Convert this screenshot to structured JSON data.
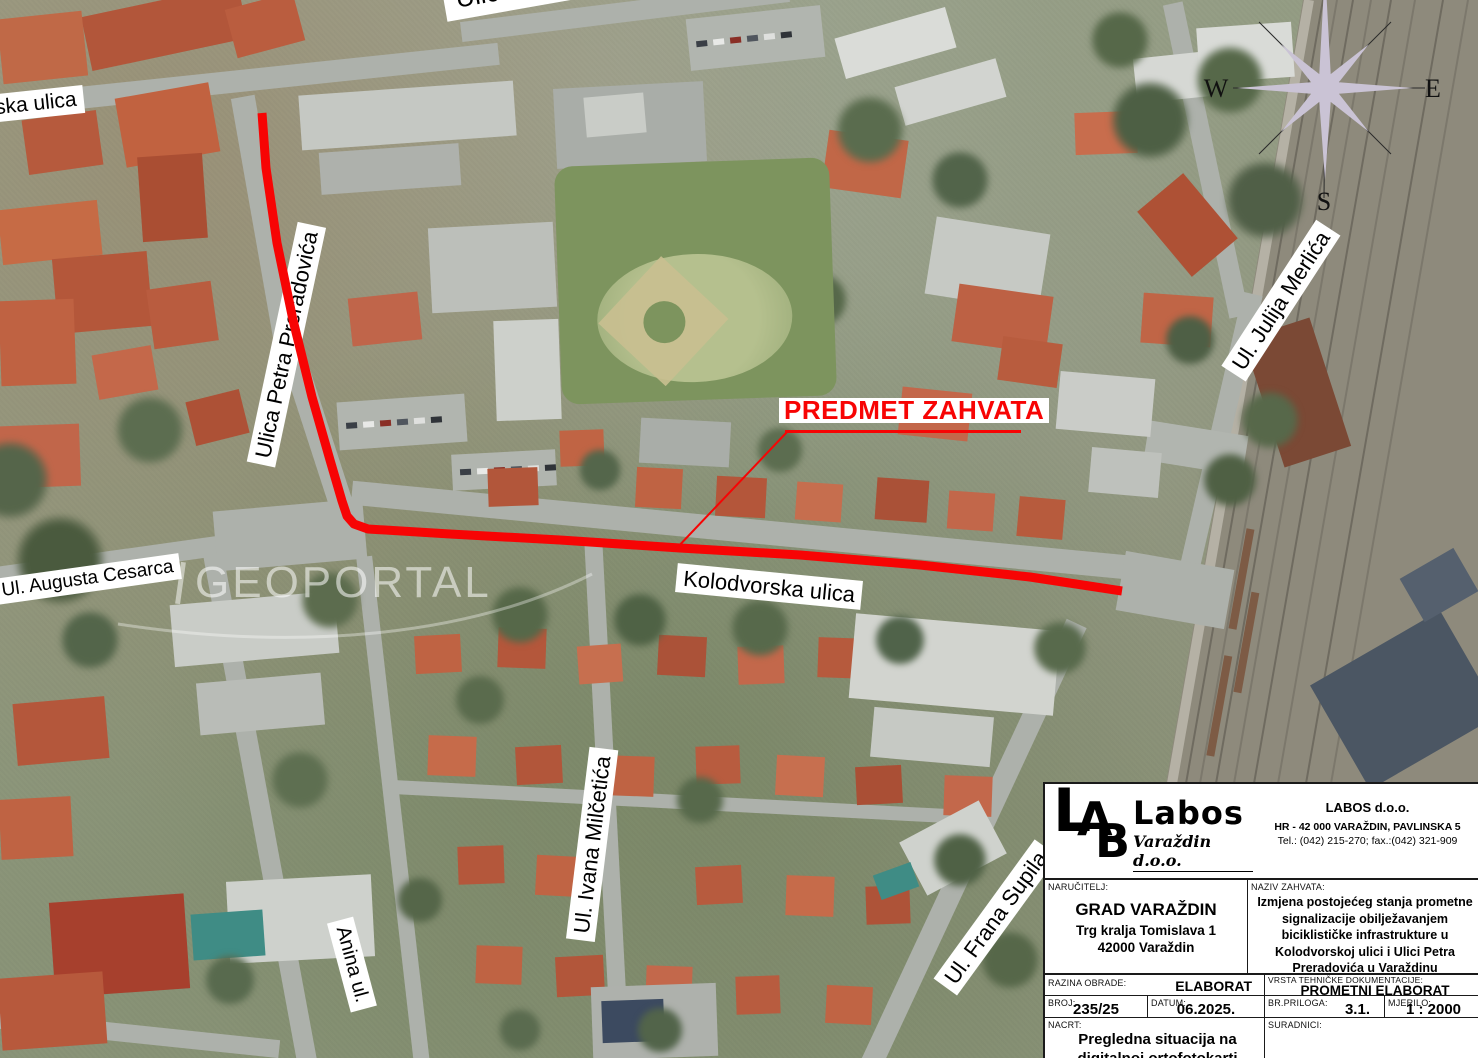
{
  "map": {
    "accent_red": "#f70404",
    "street_labels": [
      {
        "text": "ska ulica"
      },
      {
        "text": "Ulica kralja P.Kre"
      },
      {
        "text": "Ulica Petra Preradovića"
      },
      {
        "text": "Ul. Augusta Cesarca"
      },
      {
        "text": "Kolodvorska ulica"
      },
      {
        "text": "Ul. Julija Merlića"
      },
      {
        "text": "Ul. Ivana Milčetića"
      },
      {
        "text": "Anina ul."
      },
      {
        "text": "Ul. Frana Supila"
      }
    ],
    "annotation": {
      "text": "PREDMET ZAHVATA"
    },
    "watermark": "GEOPORTAL",
    "compass": {
      "w": "W",
      "e": "E",
      "s": "S"
    }
  },
  "titleblock": {
    "logo": {
      "m1": "L",
      "m2": "A",
      "m3": "B",
      "name": "Labos",
      "sub": "Varaždin d.o.o."
    },
    "company": {
      "name": "LABOS d.o.o.",
      "address": "HR - 42 000 VARAŽDIN, PAVLINSKA 5",
      "phone": "Tel.: (042) 215-270;  fax.:(042) 321-909"
    },
    "narucitelj": {
      "label": "NARUČITELJ:",
      "name": "GRAD VARAŽDIN",
      "line2": "Trg kralja Tomislava 1",
      "line3": "42000 Varaždin"
    },
    "naziv": {
      "label": "NAZIV ZAHVATA:",
      "text": "Izmjena postojećeg stanja prometne signalizacije obilježavanjem biciklističke infrastrukture u Kolodvorskoj ulici i Ulici Petra Preradovića u Varaždinu"
    },
    "razina": {
      "label": "RAZINA OBRADE:",
      "value": "ELABORAT"
    },
    "vrsta": {
      "label": "VRSTA TEHNIČKE DOKUMENTACIJE:",
      "value": "PROMETNI ELABORAT"
    },
    "broj": {
      "label": "BROJ:",
      "value": "235/25"
    },
    "datum": {
      "label": "DATUM:",
      "value": "06.2025."
    },
    "prilog": {
      "label": "BR.PRILOGA:",
      "value": "3.1."
    },
    "mjerilo": {
      "label": "MJERILO:",
      "value": "1 : 2000"
    },
    "nacrt": {
      "label": "NACRT:",
      "value": "Pregledna situacija na digitalnoj ortofotokarti"
    },
    "suradnici": {
      "label": "SURADNICI:"
    }
  }
}
